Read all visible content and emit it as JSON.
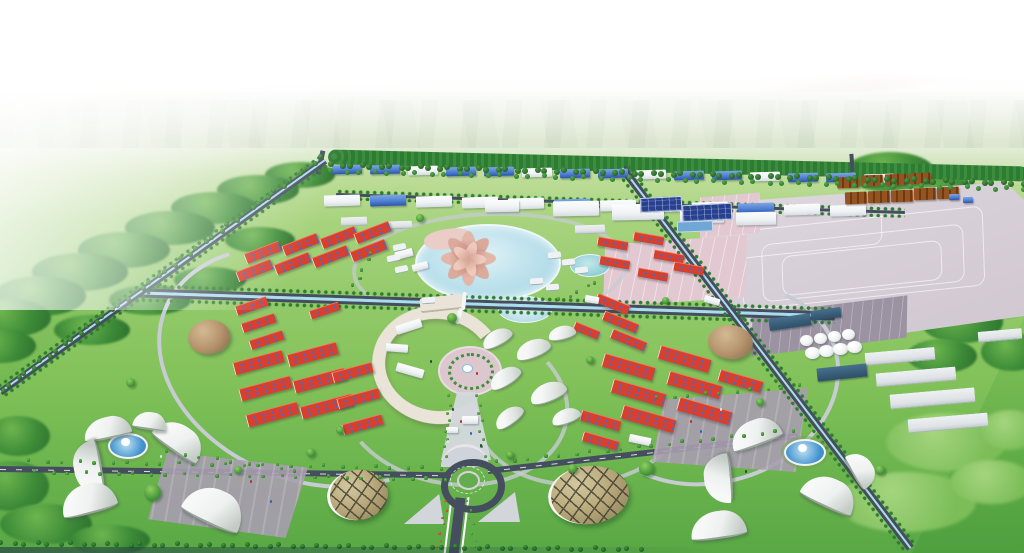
{
  "description": "3D aerial architectural rendering of an industrial park masterplan viewed from a high oblique angle under a hazy white sky",
  "counts": {
    "lotus-petals": 8,
    "storage-tanks": 8,
    "dome-buildings": 2,
    "glass-shell-pavilions": 2,
    "fountain-plazas": 3,
    "red-roof-warehouse-districts": 2
  },
  "features": [
    "sun-glow",
    "hazy-horizon",
    "distant-farm-fields",
    "perimeter-tree-buffer",
    "north-factory-band",
    "water-treatment-basins",
    "paved-container-yard",
    "brown-roof-factory-cluster",
    "storage-tank-farm",
    "lotus-landmark-building",
    "central-lake",
    "east-west-canal-boulevard",
    "southeast-boulevard",
    "west-boundary-road-and-canal",
    "red-roof-warehouses",
    "tan-dome-halls",
    "crescent-office-building",
    "circular-tree-plaza",
    "central-roundabout",
    "leaf-shaped-white-pavilions",
    "glass-shell-pavilions",
    "fan-shaped-buildings",
    "fountain-plazas",
    "tree-lined-avenues",
    "forest-patches"
  ],
  "colors": {
    "sky-top": "#ffffff",
    "sky-haze": "#f1f5ec",
    "plain": "#e0e9d5",
    "ground-mid": "#8ac465",
    "ground-low": "#4f9f40",
    "forest": "#3d8b38",
    "forest-dark": "#2c6e2d",
    "buffer": "#2d7c33",
    "road-dark": "#454e5e",
    "road-light": "#c7ccd4",
    "canal": "#aadcf0",
    "yard": "#d8d0d8",
    "pink-lot": "#e2c9d1",
    "dark-lot": "#9b93a2",
    "red-roof": "#d7402e",
    "red-ridge": "#f07a5a",
    "roof-dot": "#3d6cd7",
    "blue-roof": "#4f7fd2",
    "blue-roof-dark": "#2d54a8",
    "white-bldg": "#eff2f4",
    "brown-roof": "#955322",
    "brown-dark": "#6e3a14",
    "tan-dome": "#b6956e",
    "dome-shadow": "#8a6c4c",
    "lake": "#c2e4ee",
    "petal": "#dcaa9c",
    "petal-dark": "#c2887c",
    "cream": "#eae4d8",
    "plaza-pink": "#dbc7cd",
    "plaza-purple": "#a89eb0",
    "walkway": "#d4d8de",
    "shell-glass": "#b9ab7d",
    "shell-dark": "#8a7c55",
    "shell-line": "#3e3a2c",
    "fan-light": "#eef1f0",
    "fan-shade": "#c3cbc5",
    "tank": "#f0f3f3",
    "fountain-blue": "#3f90cf",
    "navy-bldg": "#2f4f68",
    "basin": "#27408f",
    "pink-streak": "#eed8d2"
  }
}
